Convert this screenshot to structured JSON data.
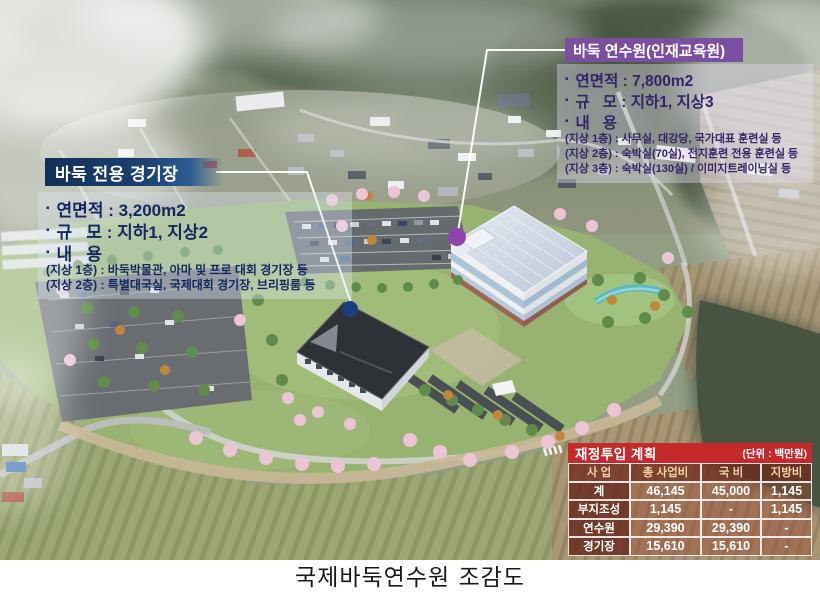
{
  "caption": "국제바둑연수원 조감도",
  "stadium_callout": {
    "title": "바둑 전용 경기장",
    "items": [
      {
        "bullet": "▪",
        "label": "연면적 : 3,200m2"
      },
      {
        "bullet": "▪",
        "label": "규   모 : 지하1, 지상2"
      },
      {
        "bullet": "▪",
        "label": "내   용"
      }
    ],
    "details": [
      "(지상 1층) : 바둑박물관, 아마 및 프로 대회 경기장 등",
      "(지상 2층) : 특별대국실, 국제대회 경기장, 브리핑룸 등"
    ]
  },
  "institute_callout": {
    "title": "바둑 연수원(인재교육원)",
    "items": [
      {
        "bullet": "▪",
        "label": "연면적 : 7,800m2"
      },
      {
        "bullet": "▪",
        "label": "규   모 : 지하1, 지상3"
      },
      {
        "bullet": "▪",
        "label": "내   용"
      }
    ],
    "details": [
      "(지상 1층) : 사무실, 대강당, 국가대표 훈련실 등",
      "(지상 2층) : 숙박실(70실), 전지훈련 전용 훈련실 등",
      "(지상 3층) : 숙박실(130실) / 이미지트레이닝실 등"
    ]
  },
  "finance_table": {
    "title": "재정투입 계획",
    "unit": "(단위 : 백만원)",
    "headers": [
      "사 업",
      "총 사업비",
      "국 비",
      "지방비"
    ],
    "rows": [
      [
        "계",
        "46,145",
        "45,000",
        "1,145"
      ],
      [
        "부지조성",
        "1,145",
        "-",
        "1,145"
      ],
      [
        "연수원",
        "29,390",
        "29,390",
        "-"
      ],
      [
        "경기장",
        "15,610",
        "15,610",
        "-"
      ]
    ]
  },
  "colors": {
    "stadium_header_navy": "#16345f",
    "institute_header_purple": "#7b4fa0",
    "finance_title_red": "#c5292c",
    "stadium_marker_navy": "#1e3f7d",
    "institute_marker_purple": "#8f44ad",
    "callout_text_navy": "#14275f",
    "callout_text_purple": "#342468"
  }
}
